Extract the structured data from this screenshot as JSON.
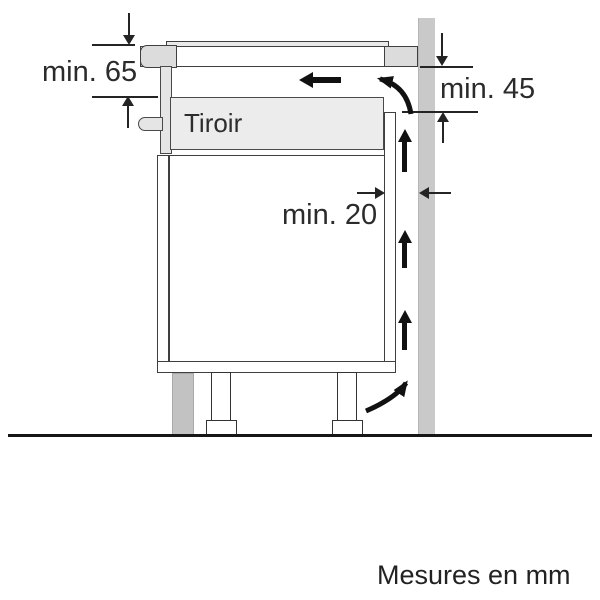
{
  "diagram": {
    "type": "appliance-installation-section",
    "drawer_label": "Tiroir",
    "dimensions": {
      "top_clearance": "min. 65",
      "right_clearance": "min. 45",
      "wall_gap": "min. 20"
    },
    "footer_note": "Mesures en mm",
    "icons": [
      "airflow-left-arrow",
      "airflow-curve-top-arrow",
      "airflow-curve-bottom-arrow",
      "airflow-up-arrow",
      "dimension-arrow"
    ],
    "colors": {
      "background": "#ffffff",
      "wall_fill": "#c9c9c9",
      "panel_fill": "#e5e5e5",
      "drawer_fill": "#ececec",
      "plinth_fill": "#c2c2c2",
      "outline": "#3f3f3f",
      "dimension_line": "#242424",
      "airflow_arrow": "#111111"
    }
  }
}
